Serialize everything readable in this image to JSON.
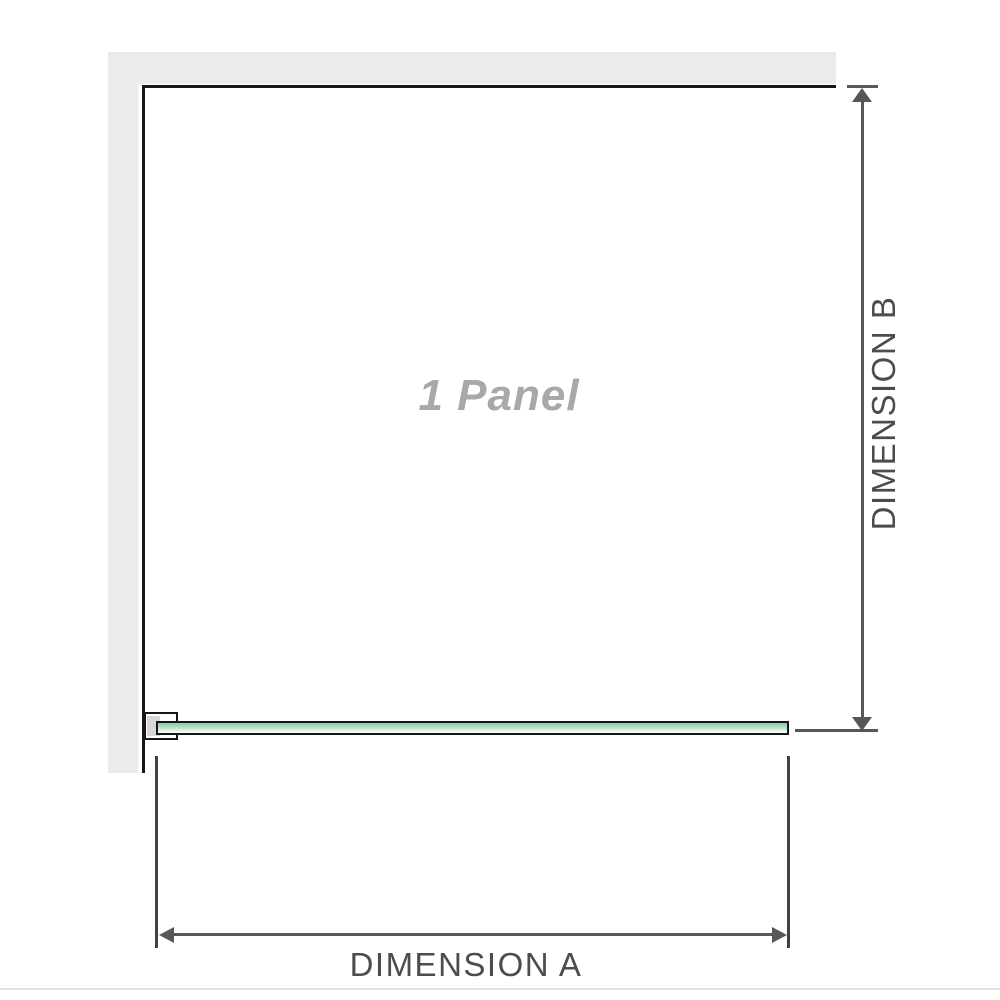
{
  "labels": {
    "panel": "1 Panel",
    "dimension_a": "DIMENSION A",
    "dimension_b": "DIMENSION B"
  },
  "colors": {
    "background": "#ffffff",
    "wall_fill": "#ebebeb",
    "outline_black": "#161616",
    "glass_green_top": "#8ecba4",
    "glass_green_bottom": "#f8fcf9",
    "dimension_line": "#55585b",
    "dimension_text": "#4a4d4f",
    "panel_text": "#a8a8a8",
    "bracket_inner_gray": "#d7d7d7",
    "bottom_separator": "#e3e3e0"
  },
  "icons": {
    "dimension_b_top": "arrow-up-icon",
    "dimension_b_bottom": "arrow-down-icon",
    "dimension_a_left": "arrow-left-icon",
    "dimension_a_right": "arrow-right-icon"
  }
}
